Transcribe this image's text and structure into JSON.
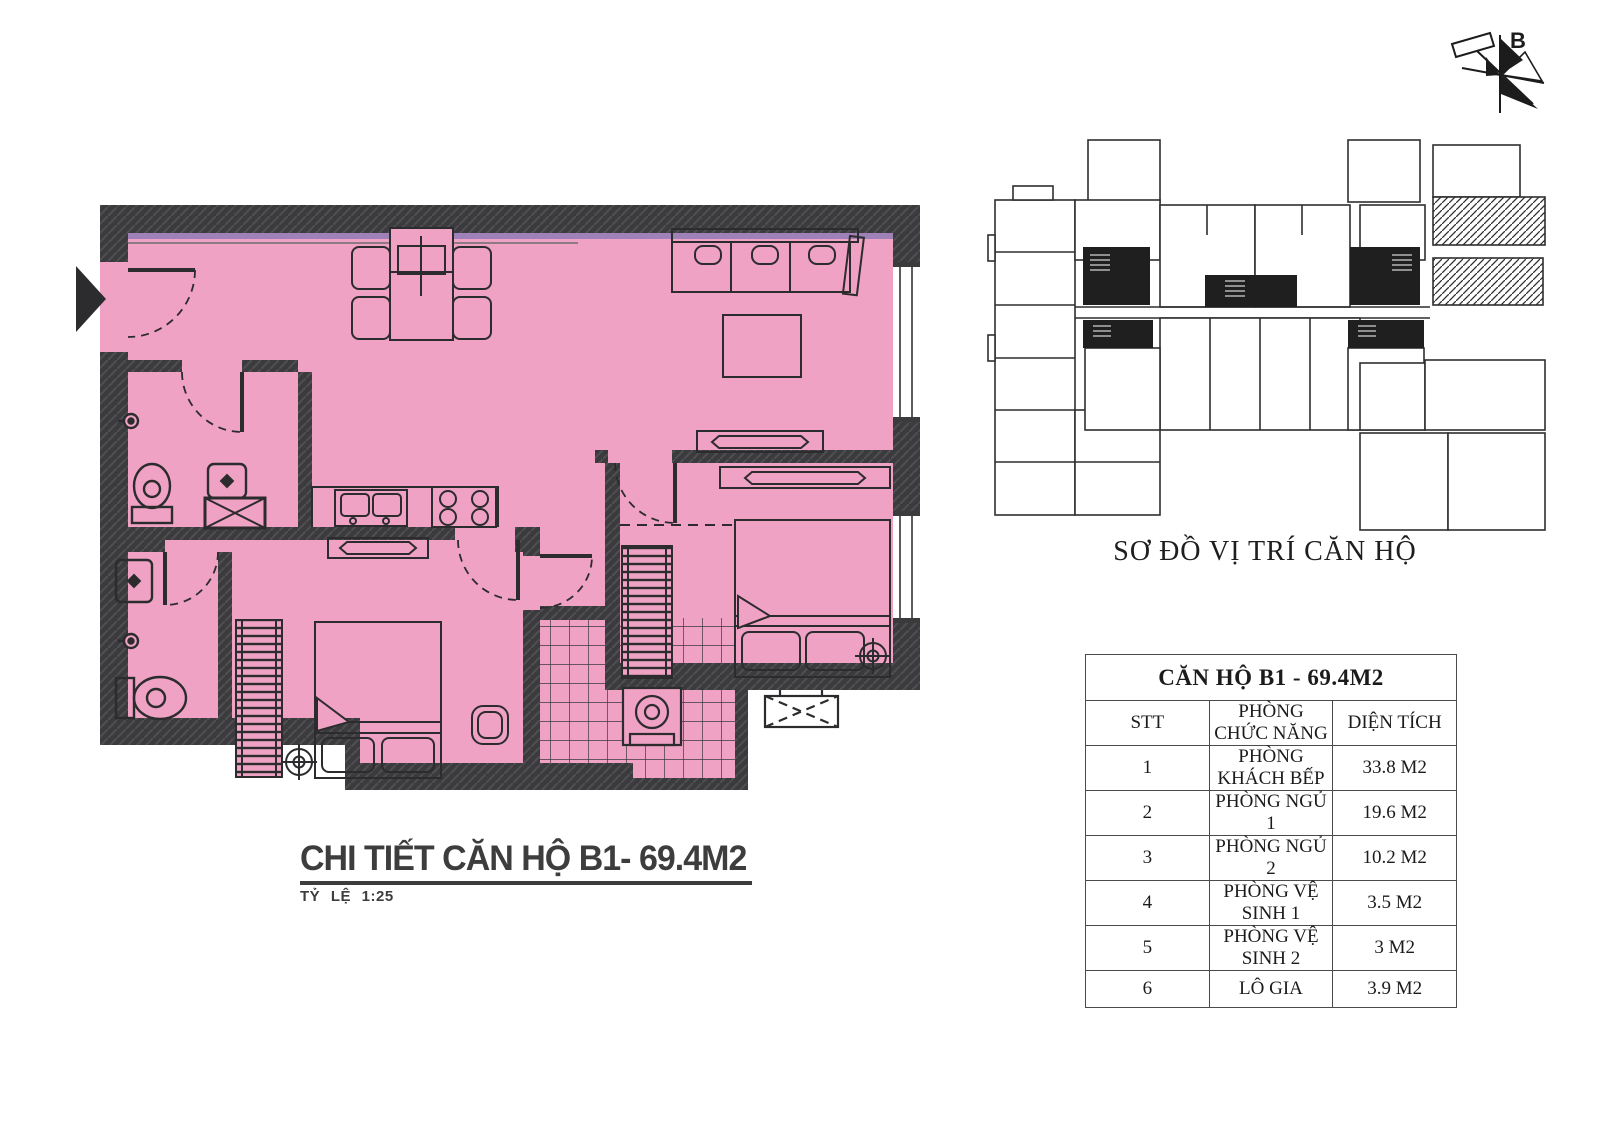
{
  "colors": {
    "apartment_fill": "#efa2c3",
    "wall": "#3b3a3c",
    "line": "#2c2b2d",
    "accent_stripe": "#8f7bb5"
  },
  "compass": {
    "north_label": "B"
  },
  "key_plan": {
    "caption": "SƠ ĐỒ VỊ TRÍ CĂN HỘ"
  },
  "detail": {
    "title": "CHI TIẾT CĂN HỘ B1- 69.4M2",
    "scale": "TỶ LỆ 1:25"
  },
  "table": {
    "title": "CĂN HỘ B1 - 69.4M2",
    "headers": {
      "stt": "STT",
      "room": "PHÒNG CHỨC NĂNG",
      "area": "DIỆN TÍCH"
    },
    "rows": [
      {
        "stt": "1",
        "room": "PHÒNG KHÁCH BẾP",
        "area": "33.8 M2"
      },
      {
        "stt": "2",
        "room": "PHÒNG NGỦ 1",
        "area": "19.6 M2"
      },
      {
        "stt": "3",
        "room": "PHÒNG NGỦ 2",
        "area": "10.2 M2"
      },
      {
        "stt": "4",
        "room": "PHÒNG VỆ SINH 1",
        "area": "3.5 M2"
      },
      {
        "stt": "5",
        "room": "PHÒNG VỆ SINH 2",
        "area": "3 M2"
      },
      {
        "stt": "6",
        "room": "LÔ GIA",
        "area": "3.9 M2"
      }
    ]
  }
}
